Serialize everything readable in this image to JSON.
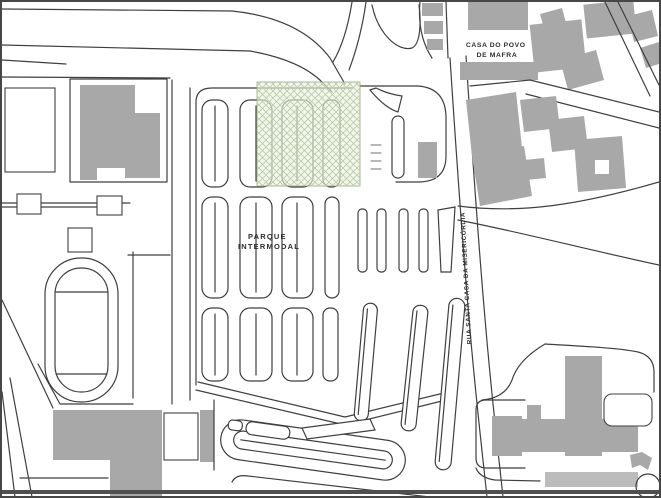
{
  "map": {
    "labels": {
      "parking": {
        "line1": "PARQUE",
        "line2": "INTERMODAL"
      },
      "casa_do_povo": {
        "line1": "CASA DO POVO",
        "line2": "DE MAFRA"
      },
      "street": "RUA SANTA CASA DA MISERICÓRDIA"
    },
    "colors": {
      "line": "#3f3f3f",
      "line_soft": "#707070",
      "building": "#a8a8a8",
      "building_light": "#bcbcbc",
      "highlight_fill": "#eaf0e1",
      "highlight_hatch": "#b9cba3",
      "highlight_border": "#96a884",
      "background": "#ffffff",
      "frame": "#474747",
      "text": "#2e2e2e"
    }
  }
}
